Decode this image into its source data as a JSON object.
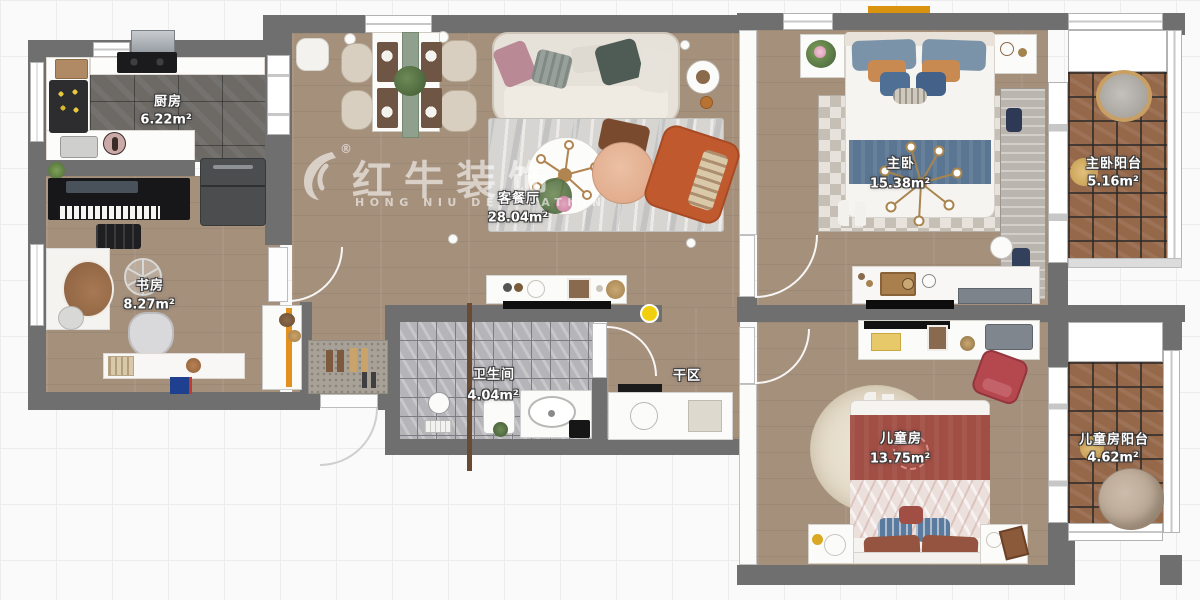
{
  "watermark": {
    "reg": "®",
    "brand": "红牛装饰",
    "sub": "HONG NIU DECORATION"
  },
  "rooms": {
    "kitchen": {
      "name": "厨房",
      "area": "6.22m²"
    },
    "study": {
      "name": "书房",
      "area": "8.27m²"
    },
    "living": {
      "name": "客餐厅",
      "area": "28.04m²"
    },
    "bathroom": {
      "name": "卫生间",
      "area": "4.04m²"
    },
    "dry_area": {
      "name": "干区"
    },
    "master": {
      "name": "主卧",
      "area": "15.38m²"
    },
    "master_balcony": {
      "name": "主卧阳台",
      "area": "5.16m²"
    },
    "kids": {
      "name": "儿童房",
      "area": "13.75m²"
    },
    "kids_balcony": {
      "name": "儿童房阳台",
      "area": "4.62m²"
    }
  },
  "colors": {
    "wall": "#6f6f6f",
    "wood": "#a5907c",
    "ktile": "#6d6a66",
    "btile": "#b5b5b9",
    "terra": "#96684a",
    "accent": "#e2911f",
    "sofa": "#e7e2d9",
    "orange_chair": "#c05a2e",
    "blue_pillow": "#7b93a8",
    "blue_runner": "#5b7693",
    "red_bed": "#a14e44",
    "yellow_dot": "#f2cf0e",
    "label": "#ffffff"
  }
}
